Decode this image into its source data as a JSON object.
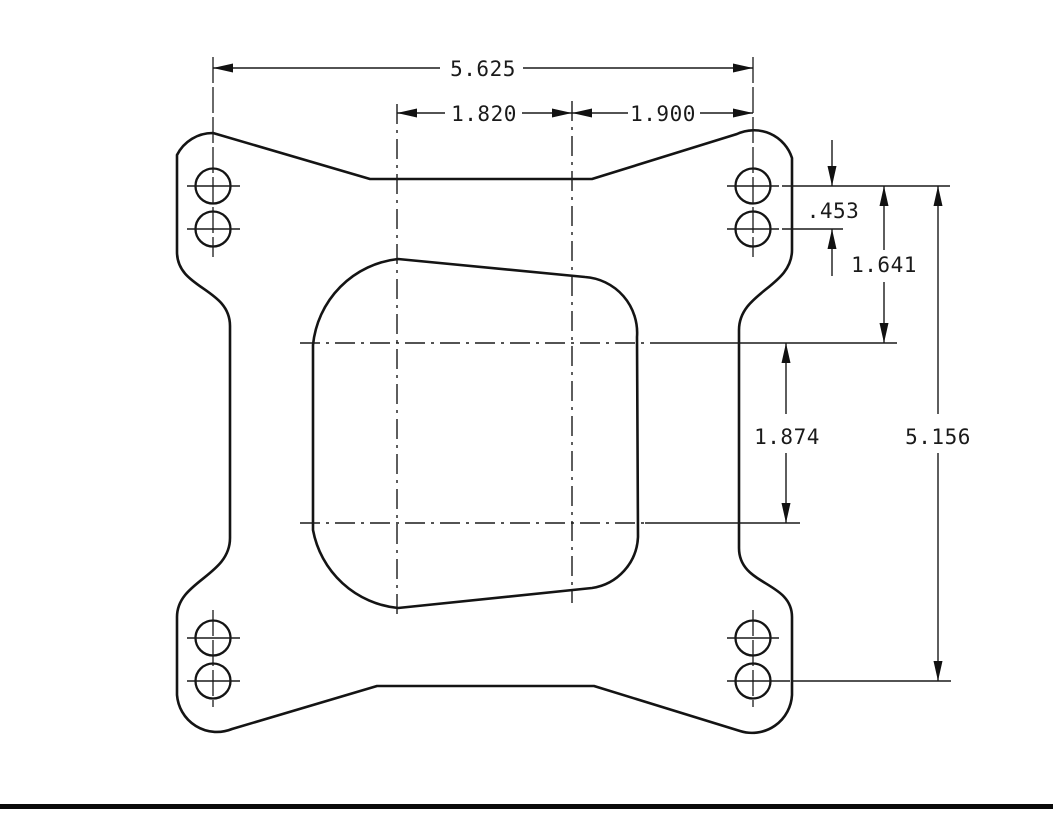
{
  "drawing": {
    "dimensions": {
      "overall_width": {
        "label": "5.625"
      },
      "bore_span_left": {
        "label": "1.820"
      },
      "bore_to_bolt_right": {
        "label": "1.900"
      },
      "bolt_hole_pair_gap": {
        "label": ".453"
      },
      "bolt_to_bore_center": {
        "label": "1.641"
      },
      "bore_center_spacing": {
        "label": "1.874"
      },
      "overall_height": {
        "label": "5.156"
      }
    },
    "line_color": "#141414",
    "background_color": "#ffffff",
    "bottom_border_color": "#0a0a0a"
  }
}
